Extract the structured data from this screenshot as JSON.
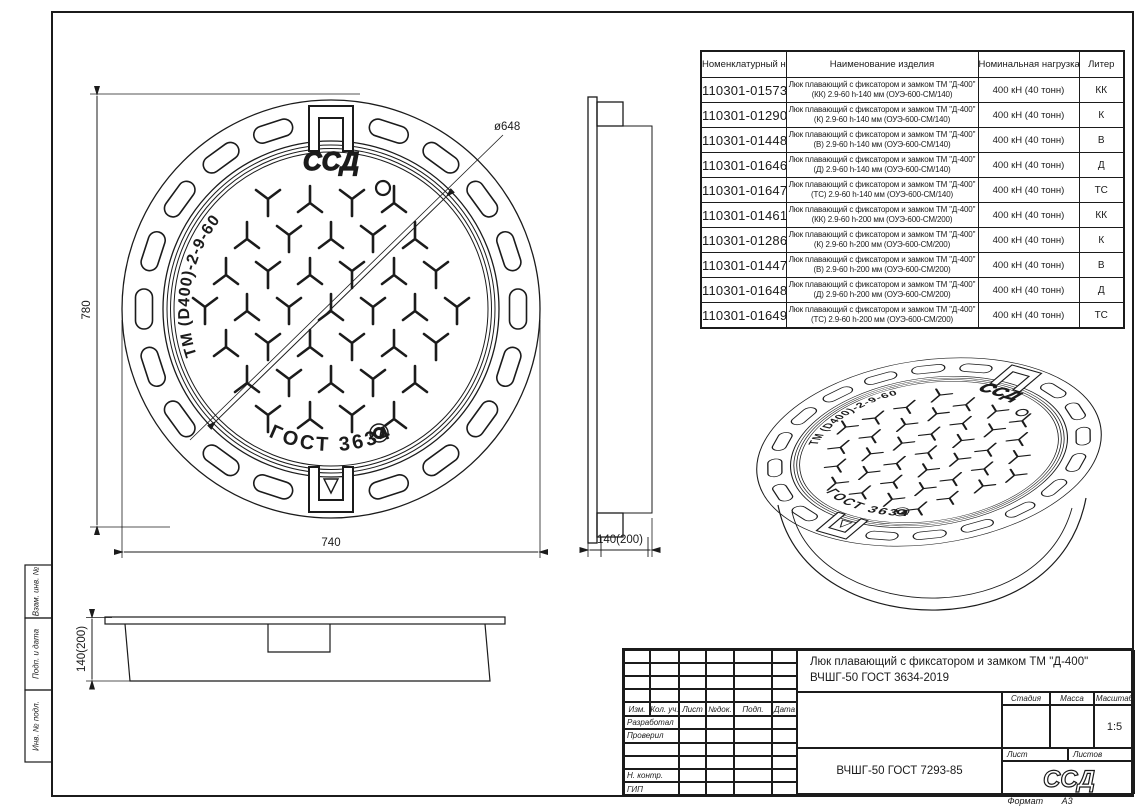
{
  "colors": {
    "line": "#1b1b1b",
    "background": "#ffffff"
  },
  "drawing": {
    "cover_markings": {
      "brand_arc_text": "ТМ (D400)-2-9-60",
      "gost_arc_text": "ГОСТ 3634",
      "logo_text": "ССД"
    },
    "front_view": {
      "dim_height": "780",
      "dim_width": "740",
      "dim_diameter": "ø648"
    },
    "side_view": {
      "dim_depth": "140(200)"
    },
    "bottom_view": {
      "dim_depth": "140(200)"
    }
  },
  "parts_table": {
    "headers": [
      "Номенклатурный номер",
      "Наименование изделия",
      "Номинальная нагрузка",
      "Литер"
    ],
    "rows": [
      {
        "num": "110301-01573",
        "name_line1": "Люк плавающий с фиксатором и замком ТМ \"Д-400\"",
        "name_line2": "(КК) 2.9-60 h-140 мм (ОУЭ-600-СМ/140)",
        "load": "400 кН (40 тонн)",
        "liter": "КК"
      },
      {
        "num": "110301-01290",
        "name_line1": "Люк плавающий с фиксатором и замком ТМ \"Д-400\"",
        "name_line2": "(К) 2.9-60 h-140 мм (ОУЭ-600-СМ/140)",
        "load": "400 кН (40 тонн)",
        "liter": "К"
      },
      {
        "num": "110301-01448",
        "name_line1": "Люк плавающий с фиксатором и замком ТМ \"Д-400\"",
        "name_line2": "(В) 2.9-60 h-140 мм (ОУЭ-600-СМ/140)",
        "load": "400 кН (40 тонн)",
        "liter": "В"
      },
      {
        "num": "110301-01646",
        "name_line1": "Люк плавающий с фиксатором и замком ТМ \"Д-400\"",
        "name_line2": "(Д) 2.9-60 h-140 мм (ОУЭ-600-СМ/140)",
        "load": "400 кН (40 тонн)",
        "liter": "Д"
      },
      {
        "num": "110301-01647",
        "name_line1": "Люк плавающий с фиксатором и замком ТМ \"Д-400\"",
        "name_line2": "(ТС) 2.9-60 h-140 мм (ОУЭ-600-СМ/140)",
        "load": "400 кН (40 тонн)",
        "liter": "ТС"
      },
      {
        "num": "110301-01461",
        "name_line1": "Люк плавающий с фиксатором и замком ТМ \"Д-400\"",
        "name_line2": "(КК) 2.9-60 h-200 мм (ОУЭ-600-СМ/200)",
        "load": "400 кН (40 тонн)",
        "liter": "КК"
      },
      {
        "num": "110301-01286",
        "name_line1": "Люк плавающий с фиксатором и замком ТМ \"Д-400\"",
        "name_line2": "(К) 2.9-60 h-200 мм (ОУЭ-600-СМ/200)",
        "load": "400 кН (40 тонн)",
        "liter": "К"
      },
      {
        "num": "110301-01447",
        "name_line1": "Люк плавающий с фиксатором и замком ТМ \"Д-400\"",
        "name_line2": "(В) 2.9-60 h-200 мм (ОУЭ-600-СМ/200)",
        "load": "400 кН (40 тонн)",
        "liter": "В"
      },
      {
        "num": "110301-01648",
        "name_line1": "Люк плавающий с фиксатором и замком ТМ \"Д-400\"",
        "name_line2": "(Д) 2.9-60 h-200 мм (ОУЭ-600-СМ/200)",
        "load": "400 кН (40 тонн)",
        "liter": "Д"
      },
      {
        "num": "110301-01649",
        "name_line1": "Люк плавающий с фиксатором и замком ТМ \"Д-400\"",
        "name_line2": "(ТС) 2.9-60 h-200 мм (ОУЭ-600-СМ/200)",
        "load": "400 кН (40 тонн)",
        "liter": "ТС"
      }
    ]
  },
  "title_block": {
    "title_line1": "Люк плавающий с фиксатором и замком ТМ \"Д-400\"",
    "title_line2": "ВЧШГ-50 ГОСТ 3634-2019",
    "revision_cols": [
      "Изм.",
      "Кол. уч.",
      "Лист",
      "№док.",
      "Подп.",
      "Дата"
    ],
    "signature_rows": [
      "Разработал",
      "Проверил",
      "",
      "",
      "Н. контр.",
      "ГИП"
    ],
    "stage_label": "Стадия",
    "mass_label": "Масса",
    "scale_label": "Масштаб",
    "scale_value": "1:5",
    "sheet_label": "Лист",
    "sheets_label": "Листов",
    "material": "ВЧШГ-50 ГОСТ 7293-85",
    "logo_text": "ССД",
    "format_label": "Формат",
    "format_value": "А3"
  },
  "frame_labels": [
    "Взам. инв. №",
    "Подп. и дата",
    "Инв. № подл."
  ]
}
